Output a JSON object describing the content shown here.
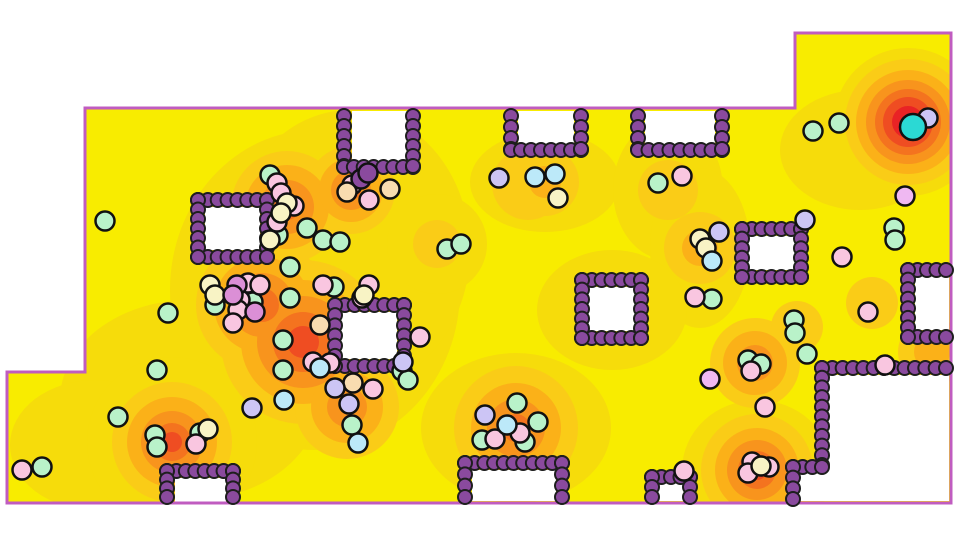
{
  "scene": {
    "canvas": {
      "width": 960,
      "height": 540
    },
    "colors": {
      "background": "#FFFFFF",
      "boundary": "#C05CC0",
      "heat_base": "#F8EC00",
      "heat_levels": [
        "#F6DC0B",
        "#FACC17",
        "#FBB118",
        "#F8941D",
        "#F4731F",
        "#EF4D22",
        "#E92325"
      ],
      "wall_fill": "#8A4A9E",
      "wall_stroke": "#1E1E1E",
      "agent_stroke": "#111111",
      "agent_palette": {
        "mint": "#B9F2C9",
        "pink": "#F9C6E0",
        "lavender": "#CCC5F5",
        "lightblue": "#BCE9F9",
        "cream": "#F8F3C5",
        "peach": "#F8DCB0",
        "orchid": "#DB8FD6",
        "violet": "#EFB8F2",
        "cyan": "#2BD9D4",
        "darkpurple": "#8A4A9E"
      }
    },
    "boundary_polygon": [
      [
        85,
        108
      ],
      [
        795,
        108
      ],
      [
        795,
        33
      ],
      [
        951,
        33
      ],
      [
        951,
        503
      ],
      [
        7,
        503
      ],
      [
        7,
        372
      ],
      [
        85,
        372
      ]
    ],
    "white_pockets": [
      [
        352,
        111,
        55,
        51
      ],
      [
        518,
        111,
        56,
        37
      ],
      [
        645,
        111,
        70,
        37
      ],
      [
        205,
        207,
        55,
        43
      ],
      [
        341,
        312,
        56,
        47
      ],
      [
        588,
        287,
        47,
        44
      ],
      [
        748,
        236,
        47,
        34
      ],
      [
        915,
        276,
        34,
        54
      ],
      [
        175,
        478,
        51,
        24
      ],
      [
        472,
        470,
        84,
        31
      ],
      [
        658,
        482,
        26,
        19
      ]
    ],
    "excluded_polygon": [
      [
        828,
        375
      ],
      [
        949,
        375
      ],
      [
        949,
        501
      ],
      [
        795,
        501
      ],
      [
        795,
        472
      ],
      [
        828,
        472
      ]
    ],
    "heat_blobs": [
      {
        "cx": 908,
        "cy": 122,
        "rings": [
          [
            1,
            74
          ],
          [
            2,
            63
          ],
          [
            3,
            52
          ],
          [
            4,
            42
          ],
          [
            5,
            33
          ],
          [
            6,
            25
          ],
          [
            7,
            16
          ]
        ]
      },
      {
        "cx": 860,
        "cy": 150,
        "rings": [
          [
            1,
            80,
            60
          ]
        ]
      },
      {
        "cx": 315,
        "cy": 290,
        "rings": [
          [
            1,
            145,
            160
          ]
        ]
      },
      {
        "cx": 190,
        "cy": 400,
        "rings": [
          [
            1,
            130,
            100
          ]
        ]
      },
      {
        "cx": 350,
        "cy": 250,
        "rings": [
          [
            1,
            120,
            140
          ]
        ]
      },
      {
        "cx": 95,
        "cy": 445,
        "rings": [
          [
            1,
            85,
            65
          ]
        ]
      },
      {
        "cx": 303,
        "cy": 342,
        "rings": [
          [
            2,
            82
          ],
          [
            3,
            62
          ],
          [
            4,
            46
          ],
          [
            5,
            30
          ],
          [
            6,
            16
          ]
        ]
      },
      {
        "cx": 262,
        "cy": 305,
        "rings": [
          [
            2,
            66
          ],
          [
            3,
            48
          ],
          [
            4,
            32
          ],
          [
            5,
            17
          ]
        ]
      },
      {
        "cx": 287,
        "cy": 207,
        "rings": [
          [
            2,
            56
          ],
          [
            3,
            42
          ],
          [
            4,
            27
          ],
          [
            5,
            13
          ]
        ]
      },
      {
        "cx": 351,
        "cy": 190,
        "rings": [
          [
            2,
            44
          ],
          [
            3,
            32
          ],
          [
            4,
            20
          ],
          [
            5,
            10
          ]
        ]
      },
      {
        "cx": 347,
        "cy": 407,
        "rings": [
          [
            2,
            52
          ],
          [
            3,
            36
          ],
          [
            4,
            20
          ]
        ]
      },
      {
        "cx": 172,
        "cy": 442,
        "rings": [
          [
            1,
            85
          ],
          [
            2,
            60
          ],
          [
            3,
            45
          ],
          [
            4,
            31
          ],
          [
            5,
            19
          ],
          [
            6,
            10
          ]
        ]
      },
      {
        "cx": 516,
        "cy": 428,
        "rings": [
          [
            1,
            95,
            75
          ],
          [
            2,
            62
          ],
          [
            3,
            45
          ],
          [
            4,
            29
          ],
          [
            5,
            14
          ]
        ]
      },
      {
        "cx": 757,
        "cy": 470,
        "rings": [
          [
            1,
            75,
            70
          ],
          [
            2,
            56
          ],
          [
            3,
            42
          ],
          [
            4,
            30
          ],
          [
            5,
            19
          ],
          [
            6,
            10
          ]
        ]
      },
      {
        "cx": 755,
        "cy": 363,
        "rings": [
          [
            2,
            45
          ],
          [
            3,
            32
          ],
          [
            4,
            18
          ]
        ]
      },
      {
        "cx": 545,
        "cy": 182,
        "rings": [
          [
            1,
            75,
            50
          ],
          [
            2,
            34
          ],
          [
            3,
            16
          ]
        ]
      },
      {
        "cx": 528,
        "cy": 184,
        "rings": [
          [
            2,
            36
          ]
        ]
      },
      {
        "cx": 668,
        "cy": 190,
        "rings": [
          [
            1,
            55,
            70
          ],
          [
            2,
            30
          ]
        ]
      },
      {
        "cx": 700,
        "cy": 248,
        "rings": [
          [
            1,
            50,
            80
          ],
          [
            2,
            36
          ],
          [
            3,
            18
          ]
        ]
      },
      {
        "cx": 437,
        "cy": 244,
        "rings": [
          [
            1,
            50
          ],
          [
            2,
            24
          ]
        ]
      },
      {
        "cx": 872,
        "cy": 303,
        "rings": [
          [
            2,
            26
          ]
        ]
      },
      {
        "cx": 932,
        "cy": 352,
        "rings": [
          [
            2,
            34
          ],
          [
            3,
            18
          ]
        ]
      },
      {
        "cx": 797,
        "cy": 327,
        "rings": [
          [
            2,
            26
          ]
        ]
      },
      {
        "cx": 612,
        "cy": 310,
        "rings": [
          [
            1,
            75,
            60
          ]
        ]
      }
    ],
    "walls": {
      "r": 7,
      "gap": 10,
      "segments": [
        [
          344,
          116,
          344,
          166
        ],
        [
          344,
          167,
          413,
          167
        ],
        [
          413,
          116,
          413,
          166
        ],
        [
          511,
          116,
          511,
          149
        ],
        [
          511,
          150,
          581,
          150
        ],
        [
          581,
          116,
          581,
          149
        ],
        [
          638,
          116,
          638,
          149
        ],
        [
          638,
          150,
          722,
          150
        ],
        [
          722,
          116,
          722,
          149
        ],
        [
          198,
          200,
          267,
          200
        ],
        [
          198,
          257,
          267,
          257
        ],
        [
          198,
          200,
          198,
          257
        ],
        [
          267,
          200,
          267,
          257
        ],
        [
          335,
          305,
          404,
          305
        ],
        [
          335,
          366,
          404,
          366
        ],
        [
          335,
          305,
          335,
          366
        ],
        [
          404,
          305,
          404,
          366
        ],
        [
          582,
          280,
          641,
          280
        ],
        [
          582,
          338,
          641,
          338
        ],
        [
          582,
          280,
          582,
          338
        ],
        [
          641,
          280,
          641,
          338
        ],
        [
          742,
          229,
          801,
          229
        ],
        [
          742,
          277,
          801,
          277
        ],
        [
          742,
          229,
          742,
          277
        ],
        [
          801,
          229,
          801,
          277
        ],
        [
          908,
          270,
          946,
          270
        ],
        [
          908,
          337,
          946,
          337
        ],
        [
          908,
          270,
          908,
          337
        ],
        [
          822,
          368,
          946,
          368
        ],
        [
          822,
          368,
          822,
          465
        ],
        [
          793,
          467,
          822,
          467
        ],
        [
          793,
          467,
          793,
          499
        ],
        [
          167,
          471,
          233,
          471
        ],
        [
          167,
          471,
          167,
          497
        ],
        [
          233,
          471,
          233,
          497
        ],
        [
          465,
          463,
          562,
          463
        ],
        [
          465,
          463,
          465,
          497
        ],
        [
          562,
          463,
          562,
          497
        ],
        [
          652,
          477,
          690,
          477
        ],
        [
          652,
          477,
          652,
          497
        ],
        [
          690,
          477,
          690,
          497
        ]
      ]
    },
    "agents": [
      [
        "mint",
        105,
        221
      ],
      [
        "mint",
        168,
        313
      ],
      [
        "mint",
        157,
        370
      ],
      [
        "mint",
        118,
        417
      ],
      [
        "mint",
        42,
        467
      ],
      [
        "mint",
        155,
        435
      ],
      [
        "mint",
        157,
        447
      ],
      [
        "mint",
        200,
        433
      ],
      [
        "mint",
        283,
        340
      ],
      [
        "mint",
        283,
        370
      ],
      [
        "mint",
        290,
        267
      ],
      [
        "mint",
        290,
        298
      ],
      [
        "mint",
        215,
        305
      ],
      [
        "mint",
        253,
        302
      ],
      [
        "mint",
        270,
        175
      ],
      [
        "mint",
        278,
        235
      ],
      [
        "mint",
        307,
        228
      ],
      [
        "mint",
        323,
        240
      ],
      [
        "mint",
        340,
        242
      ],
      [
        "mint",
        334,
        287
      ],
      [
        "mint",
        352,
        425
      ],
      [
        "mint",
        402,
        371
      ],
      [
        "mint",
        408,
        380
      ],
      [
        "mint",
        447,
        249
      ],
      [
        "mint",
        461,
        244
      ],
      [
        "mint",
        482,
        440
      ],
      [
        "mint",
        517,
        403
      ],
      [
        "mint",
        525,
        442
      ],
      [
        "mint",
        538,
        422
      ],
      [
        "mint",
        658,
        183
      ],
      [
        "mint",
        712,
        299
      ],
      [
        "mint",
        748,
        360
      ],
      [
        "mint",
        761,
        364
      ],
      [
        "mint",
        794,
        320
      ],
      [
        "mint",
        795,
        333
      ],
      [
        "mint",
        807,
        354
      ],
      [
        "mint",
        813,
        131
      ],
      [
        "mint",
        839,
        123
      ],
      [
        "mint",
        894,
        228
      ],
      [
        "mint",
        895,
        240
      ],
      [
        "pink",
        22,
        470
      ],
      [
        "pink",
        196,
        444
      ],
      [
        "pink",
        248,
        283
      ],
      [
        "pink",
        260,
        285
      ],
      [
        "pink",
        240,
        300
      ],
      [
        "pink",
        238,
        310
      ],
      [
        "pink",
        233,
        323
      ],
      [
        "pink",
        277,
        183
      ],
      [
        "pink",
        281,
        193
      ],
      [
        "pink",
        294,
        206
      ],
      [
        "pink",
        277,
        222
      ],
      [
        "pink",
        323,
        285
      ],
      [
        "pink",
        369,
        285
      ],
      [
        "pink",
        362,
        298
      ],
      [
        "pink",
        313,
        362
      ],
      [
        "pink",
        330,
        363
      ],
      [
        "pink",
        373,
        389
      ],
      [
        "pink",
        352,
        185
      ],
      [
        "pink",
        369,
        200
      ],
      [
        "pink",
        420,
        337
      ],
      [
        "pink",
        495,
        439
      ],
      [
        "pink",
        520,
        433
      ],
      [
        "pink",
        682,
        176
      ],
      [
        "pink",
        695,
        297
      ],
      [
        "pink",
        751,
        371
      ],
      [
        "pink",
        765,
        407
      ],
      [
        "pink",
        684,
        471
      ],
      [
        "pink",
        752,
        462
      ],
      [
        "pink",
        769,
        467
      ],
      [
        "pink",
        748,
        473
      ],
      [
        "pink",
        885,
        365
      ],
      [
        "pink",
        842,
        257
      ],
      [
        "pink",
        868,
        312
      ],
      [
        "cream",
        210,
        285
      ],
      [
        "cream",
        215,
        295
      ],
      [
        "cream",
        208,
        429
      ],
      [
        "cream",
        287,
        203
      ],
      [
        "cream",
        281,
        213
      ],
      [
        "cream",
        270,
        240
      ],
      [
        "cream",
        364,
        295
      ],
      [
        "cream",
        558,
        198
      ],
      [
        "cream",
        700,
        239
      ],
      [
        "cream",
        706,
        248
      ],
      [
        "cream",
        761,
        466
      ],
      [
        "peach",
        347,
        192
      ],
      [
        "peach",
        390,
        189
      ],
      [
        "peach",
        353,
        383
      ],
      [
        "peach",
        320,
        325
      ],
      [
        "lavender",
        928,
        118
      ],
      [
        "lavender",
        805,
        220
      ],
      [
        "lavender",
        719,
        232
      ],
      [
        "lavender",
        252,
        408
      ],
      [
        "lavender",
        335,
        388
      ],
      [
        "lavender",
        349,
        404
      ],
      [
        "lavender",
        403,
        362
      ],
      [
        "lavender",
        485,
        415
      ],
      [
        "lavender",
        499,
        178
      ],
      [
        "orchid",
        237,
        285
      ],
      [
        "orchid",
        233,
        295
      ],
      [
        "orchid",
        255,
        312
      ],
      [
        "violet",
        905,
        196
      ],
      [
        "violet",
        710,
        379
      ],
      [
        "lightblue",
        284,
        400
      ],
      [
        "lightblue",
        320,
        368
      ],
      [
        "lightblue",
        358,
        443
      ],
      [
        "lightblue",
        507,
        425
      ],
      [
        "lightblue",
        535,
        177
      ],
      [
        "lightblue",
        555,
        174
      ],
      [
        "lightblue",
        712,
        261
      ],
      [
        "cyan",
        913,
        127,
        13
      ],
      [
        "darkpurple",
        361,
        179
      ],
      [
        "darkpurple",
        368,
        173
      ]
    ]
  }
}
